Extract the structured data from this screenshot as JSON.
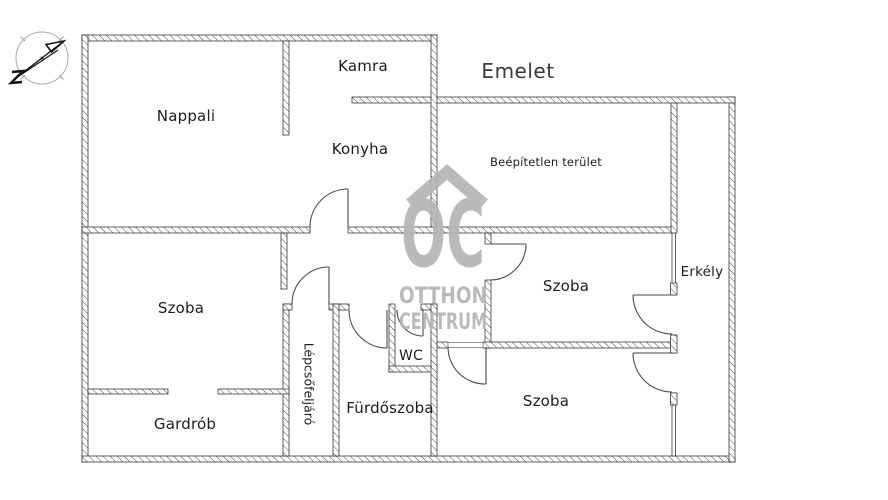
{
  "title": "Emelet",
  "rooms": {
    "nappali": "Nappali",
    "kamra": "Kamra",
    "konyha": "Konyha",
    "beepitetlen": "Beépítetlen terület",
    "szoba_felso": "Szoba",
    "szoba_bal": "Szoba",
    "szoba_also": "Szoba",
    "erkely": "Erkély",
    "gardrob": "Gardrób",
    "lepcsofeljaro": "Lépcsőfeljáró",
    "furdoszoba": "Fürdőszoba",
    "wc": "WC"
  },
  "watermark": {
    "logo": "OC",
    "line1": "OTTHON",
    "line2": "CENTRUM",
    "color": "#b5b5b5"
  },
  "plan": {
    "background": "#ffffff",
    "wall_outline": "#2e2e2e",
    "hatch_color": "#4a4a4a",
    "door_color": "#4a4a4a",
    "label_color": "#1c1c1c"
  },
  "icons": {
    "compass": "north-arrow"
  }
}
